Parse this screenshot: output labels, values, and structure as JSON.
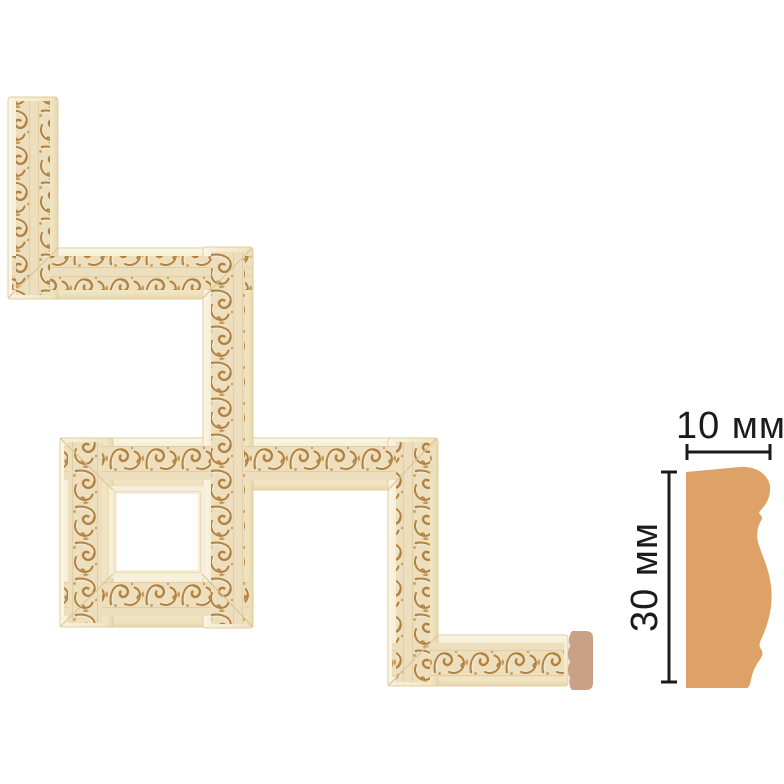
{
  "image": {
    "description": "Decorative carved molding shown as a zigzag corner layout with a square frame sample, plus end-cut cap and side cross-section profile with dimensions",
    "background": "#ffffff"
  },
  "dimensions": {
    "width_label": "10 мм",
    "height_label": "30 мм"
  },
  "colors": {
    "molding_cream": "#F5EBCE",
    "molding_edge": "#E0CEA2",
    "ornament_base": "#EDDFBE",
    "ornament_gold": "#B28140",
    "ornament_accent": "#C59B5C",
    "highlight_cream": "#FAF2DC",
    "end_cap": "#C9A187",
    "profile_fill": "#DEA266",
    "dimension_ink": "#1B1B1B"
  }
}
